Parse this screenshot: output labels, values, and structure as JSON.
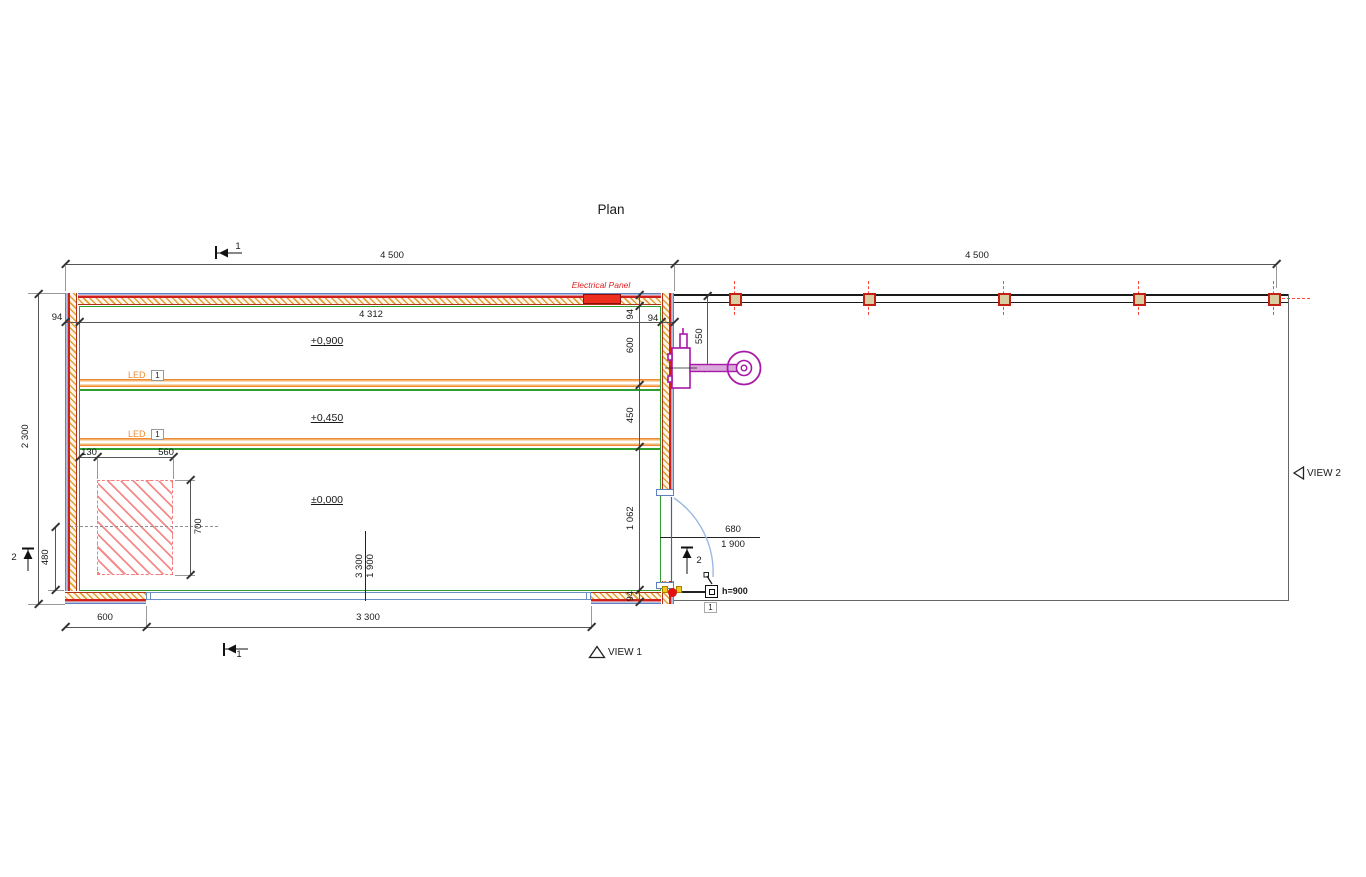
{
  "title": "Plan",
  "dims": {
    "span_left": "4 500",
    "span_right": "4 500",
    "depth": "2 300",
    "inner_width": "4 312",
    "wall_left": "94",
    "wall_right_h": "94",
    "wall_right_v": "94",
    "wall_bottom": "94",
    "zone_600": "600",
    "zone_450": "450",
    "zone_1062": "1 062",
    "equip_550": "550",
    "pad_130": "130",
    "pad_560": "560",
    "pad_700": "700",
    "pad_480": "480",
    "seg_600": "600",
    "win_3300": "3 300"
  },
  "door": {
    "width": "680",
    "height": "1 900"
  },
  "window": {
    "width": "3 300",
    "height": "1 900"
  },
  "levels": {
    "upper": "+0,900",
    "mid": "+0,450",
    "zero": "±0,000"
  },
  "labels": {
    "electrical_panel": "Electrical Panel",
    "led": "LED",
    "led_ref": "1",
    "switch": "h=900",
    "switch_ref": "1",
    "view1": "VIEW 1",
    "view2": "VIEW 2",
    "section1": "1",
    "section2": "2"
  },
  "colors": {
    "wall_outer": "#6080c0",
    "wall_red": "#cf2020",
    "insulation": "#dfa23a",
    "interior_face": "#2f9e2f",
    "shelf": "#ef8a30",
    "pad_hatch": "#f57d7d",
    "equipment": "#a819a8",
    "panel": "#ee2e1e",
    "post_fill": "#d8cda0",
    "post_border": "#c32014"
  }
}
